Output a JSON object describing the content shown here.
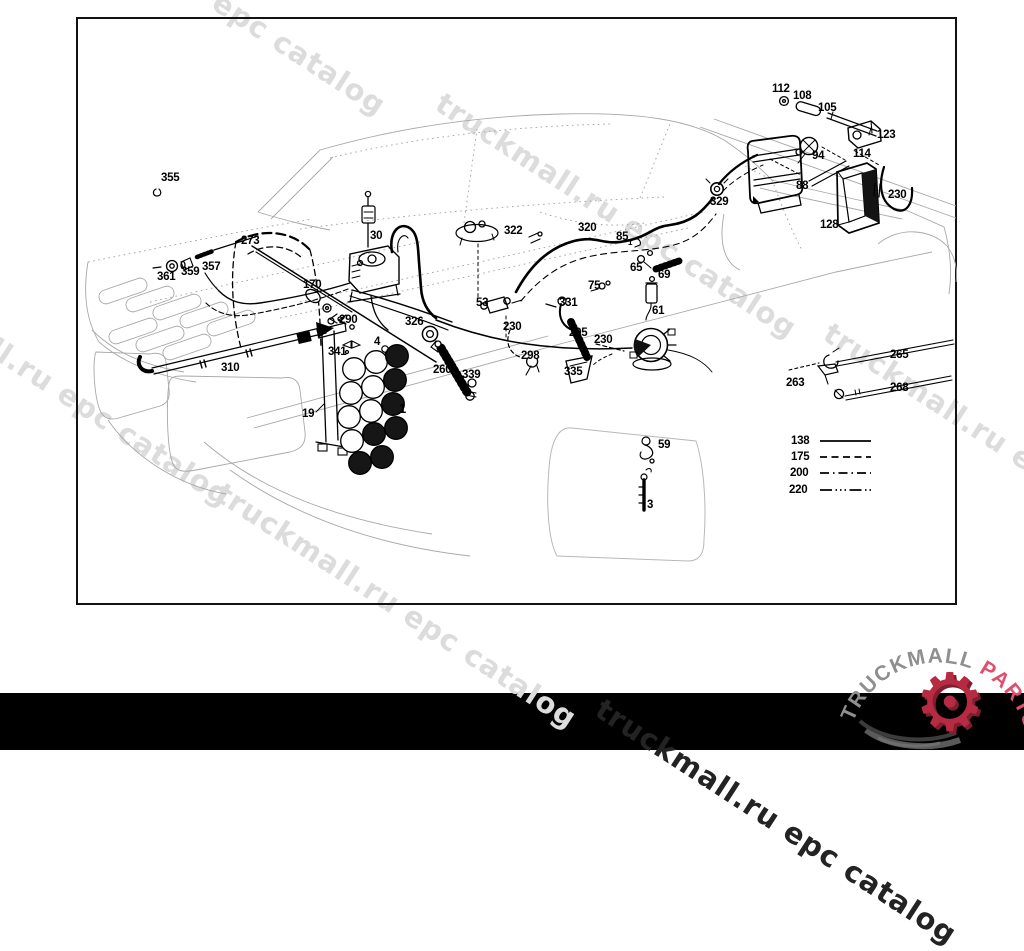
{
  "page": {
    "background": "#ffffff",
    "bottom_band_color": "#000000"
  },
  "watermarks": [
    {
      "text": "truckmall.ru epc catalog",
      "x": 37,
      "y": -137,
      "variant": "light"
    },
    {
      "text": "truckmall.ru epc catalog",
      "x": 448,
      "y": 86,
      "variant": "light"
    },
    {
      "text": "truckmall.ru epc catalog",
      "x": -118,
      "y": 254,
      "variant": "light"
    },
    {
      "text": "truckmall.ru epc catalog",
      "x": 228,
      "y": 476,
      "variant": "light"
    },
    {
      "text": "truckmall.ru epc catalog",
      "x": 836,
      "y": 316,
      "variant": "light"
    },
    {
      "text": "truckmall.ru epc catalog",
      "x": 608,
      "y": 692,
      "variant": "dark"
    }
  ],
  "diagram": {
    "part_labels": [
      {
        "t": "355",
        "x": 161,
        "y": 172
      },
      {
        "t": "361",
        "x": 157,
        "y": 271
      },
      {
        "t": "359",
        "x": 181,
        "y": 266
      },
      {
        "t": "357",
        "x": 202,
        "y": 261
      },
      {
        "t": "273",
        "x": 241,
        "y": 235
      },
      {
        "t": "30",
        "x": 370,
        "y": 230
      },
      {
        "t": "170",
        "x": 303,
        "y": 279
      },
      {
        "t": "290",
        "x": 339,
        "y": 314
      },
      {
        "t": "326",
        "x": 405,
        "y": 316
      },
      {
        "t": "341",
        "x": 328,
        "y": 346
      },
      {
        "t": "4",
        "x": 374,
        "y": 336
      },
      {
        "t": "310",
        "x": 221,
        "y": 362
      },
      {
        "t": "19",
        "x": 302,
        "y": 408
      },
      {
        "t": "1",
        "x": 399,
        "y": 401,
        "s": 13
      },
      {
        "t": "260",
        "x": 433,
        "y": 364
      },
      {
        "t": "339",
        "x": 462,
        "y": 369
      },
      {
        "t": "53",
        "x": 476,
        "y": 297
      },
      {
        "t": "230",
        "x": 503,
        "y": 321
      },
      {
        "t": "298",
        "x": 521,
        "y": 350
      },
      {
        "t": "322",
        "x": 504,
        "y": 225
      },
      {
        "t": "320",
        "x": 578,
        "y": 222
      },
      {
        "t": "329",
        "x": 710,
        "y": 196
      },
      {
        "t": "85",
        "x": 616,
        "y": 231
      },
      {
        "t": "1",
        "x": 628,
        "y": 238,
        "s": 8
      },
      {
        "t": "65",
        "x": 630,
        "y": 262
      },
      {
        "t": "69",
        "x": 658,
        "y": 269
      },
      {
        "t": "75",
        "x": 588,
        "y": 280
      },
      {
        "t": "331",
        "x": 559,
        "y": 297
      },
      {
        "t": "295",
        "x": 569,
        "y": 327
      },
      {
        "t": "230",
        "x": 594,
        "y": 334
      },
      {
        "t": "335",
        "x": 564,
        "y": 366
      },
      {
        "t": "61",
        "x": 652,
        "y": 305
      },
      {
        "t": "59",
        "x": 658,
        "y": 439
      },
      {
        "t": "3",
        "x": 647,
        "y": 499
      },
      {
        "t": "112",
        "x": 772,
        "y": 83
      },
      {
        "t": "108",
        "x": 793,
        "y": 90
      },
      {
        "t": "105",
        "x": 818,
        "y": 102
      },
      {
        "t": "123",
        "x": 877,
        "y": 129
      },
      {
        "t": "94",
        "x": 812,
        "y": 150
      },
      {
        "t": "114",
        "x": 853,
        "y": 148
      },
      {
        "t": "88",
        "x": 796,
        "y": 180
      },
      {
        "t": "230",
        "x": 888,
        "y": 189
      },
      {
        "t": "128",
        "x": 820,
        "y": 219
      },
      {
        "t": "265",
        "x": 890,
        "y": 349
      },
      {
        "t": "263",
        "x": 786,
        "y": 377
      },
      {
        "t": "268",
        "x": 890,
        "y": 382
      }
    ],
    "legend": {
      "items": [
        {
          "label": "138",
          "pattern": "solid",
          "x": 791,
          "y": 435
        },
        {
          "label": "175",
          "pattern": "dashed",
          "x": 791,
          "y": 451
        },
        {
          "label": "200",
          "pattern": "dash-dot",
          "x": 790,
          "y": 467
        },
        {
          "label": "220",
          "pattern": "dash-dot-dot",
          "x": 789,
          "y": 484
        }
      ]
    }
  },
  "logo": {
    "text_gray": "TRUCKMALL",
    "text_red": "PARTS",
    "gear_icon": "gear-icon",
    "colors": {
      "gray": "#8f8f8f",
      "red": "#df4f6e",
      "gear": "#b62a42",
      "swirl": "#4a4a4a"
    }
  }
}
